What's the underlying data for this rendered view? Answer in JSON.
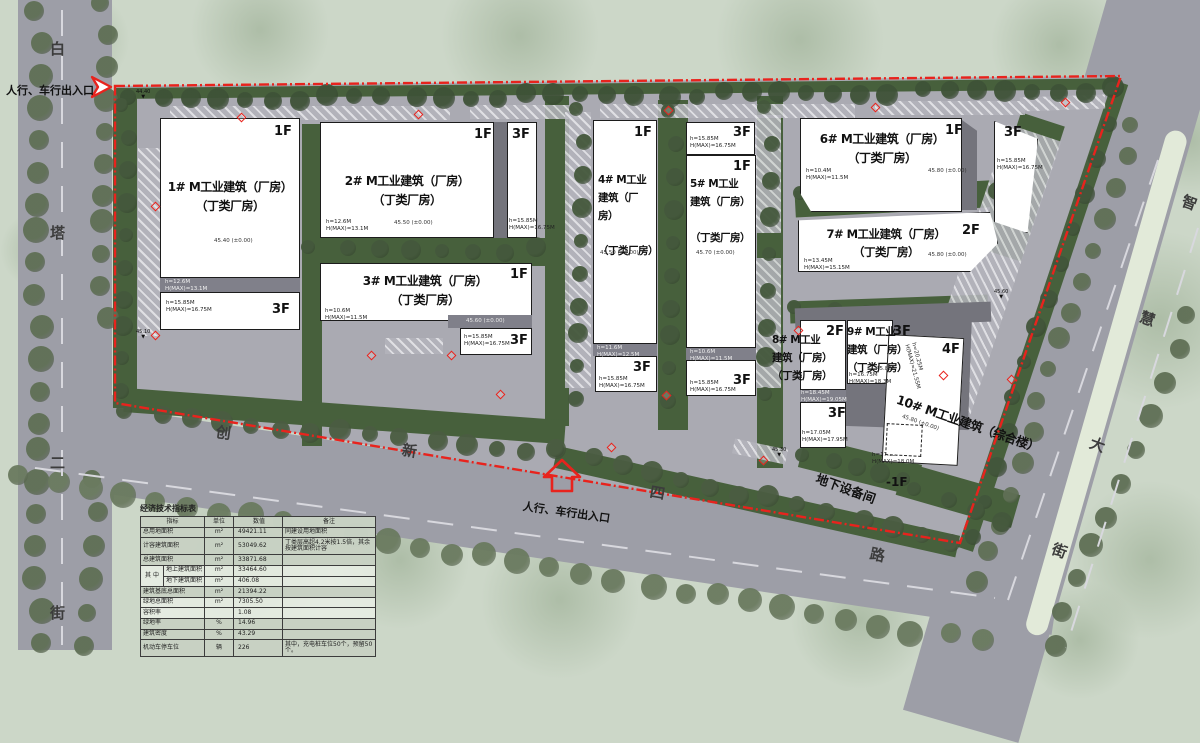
{
  "streets": {
    "west": [
      "白",
      "塔",
      "二",
      "街"
    ],
    "south": [
      "创",
      "新",
      "四",
      "路"
    ],
    "east": [
      "智",
      "慧",
      "大",
      "街"
    ]
  },
  "annotations": {
    "west_entrance": "人行、车行出入口",
    "south_entrance": "人行、车行出入口",
    "underground": "地下设备间"
  },
  "spots": [
    "44.40",
    "45.10",
    "45.30",
    "45.60"
  ],
  "buildings": [
    {
      "title": "1# M工业建筑（厂房）",
      "subtitle": "（丁类厂房）",
      "floor": "1F",
      "elev": "45.40 (±0.00)",
      "h": "h=12.6M\nH(MAX)=13.1M",
      "annex_floor": "3F",
      "annex_h": "h=15.85M\nH(MAX)=16.75M"
    },
    {
      "title": "2# M工业建筑（厂房）",
      "subtitle": "（丁类厂房）",
      "floor": "1F",
      "elev": "45.50 (±0.00)",
      "h": "h=12.6M\nH(MAX)=13.1M",
      "annex_floor": "3F",
      "annex_h": "h=15.85M\nH(MAX)=16.75M"
    },
    {
      "title": "3# M工业建筑（厂房）",
      "subtitle": "（丁类厂房）",
      "floor": "1F",
      "elev": "45.60 (±0.00)",
      "h": "h=10.6M\nH(MAX)=11.5M",
      "annex_floor": "3F",
      "annex_h": "h=15.85M\nH(MAX)=16.75M"
    },
    {
      "title": "4# M工业",
      "title2": "建筑（厂房）",
      "subtitle": "（丁类厂房）",
      "floor": "1F",
      "elev": "45.50 (±0.00)",
      "h": "h=11.6M\nH(MAX)=12.5M",
      "annex_floor": "3F",
      "annex_h": "h=15.85M\nH(MAX)=16.75M"
    },
    {
      "title": "5# M工业",
      "title2": "建筑（厂房）",
      "subtitle": "（丁类厂房）",
      "floor": "1F",
      "elev": "45.70 (±0.00)",
      "h": "h=10.6M\nH(MAX)=11.5M",
      "annex_floor": "3F",
      "annex_h": "h=15.85M\nH(MAX)=16.75M",
      "top_annex_floor": "3F",
      "top_annex_h": "h=15.85M\nH(MAX)=16.75M"
    },
    {
      "title": "6# M工业建筑（厂房）",
      "subtitle": "（丁类厂房）",
      "floor": "1F",
      "elev": "45.80 (±0.00)",
      "h": "h=10.4M\nH(MAX)=11.5M",
      "annex_floor": "3F",
      "annex_h": "h=15.85M\nH(MAX)=16.75M"
    },
    {
      "title": "7# M工业建筑（厂房）",
      "subtitle": "（丁类厂房）",
      "floor": "2F",
      "elev": "45.80 (±0.00)",
      "h": "h=13.45M\nH(MAX)=15.15M"
    },
    {
      "title": "8# M工业",
      "title2": "建筑（厂房）",
      "subtitle": "（丁类厂房）",
      "floor": "2F",
      "floor2": "3F",
      "h": "h=18.45M\nH(MAX)=19.05M",
      "h2": "h=17.05M\nH(MAX)=17.95M"
    },
    {
      "title": "9# M工业",
      "title2": "建筑（厂房）",
      "subtitle": "（丁类厂房）",
      "floor": "3F",
      "elev": "45.80",
      "h": "h=16.75M\nH(MAX)=18.3M"
    },
    {
      "title": "10# M工业建筑（综合楼）",
      "floor": "4F",
      "elev": "45.80 (±0.00)",
      "h": "h=20.25M\nH(MAX)=21.55M",
      "h2": "h=17.05M\nH(MAX)=18.0M",
      "basement": "-1F"
    }
  ],
  "table": {
    "title": "经济技术指标表",
    "headers": [
      "指标",
      "单位",
      "数值",
      "备注"
    ],
    "group_label": "其 中",
    "rows": [
      {
        "label": "总用地面积",
        "unit": "m²",
        "value": "49421.11",
        "remark": "同建设用地面积"
      },
      {
        "label": "计容建筑面积",
        "unit": "m²",
        "value": "53049.62",
        "remark": "丁类层高超4.2米按1.5倍，其余按建筑面积计容"
      },
      {
        "label": "总建筑面积",
        "unit": "m²",
        "value": "33871.68",
        "remark": ""
      },
      {
        "label": "地上建筑面积",
        "unit": "m²",
        "value": "33464.60",
        "remark": ""
      },
      {
        "label": "地下建筑面积",
        "unit": "m²",
        "value": "406.08",
        "remark": ""
      },
      {
        "label": "建筑基底总面积",
        "unit": "m²",
        "value": "21394.22",
        "remark": ""
      },
      {
        "label": "绿地总面积",
        "unit": "m²",
        "value": "7305.50",
        "remark": ""
      },
      {
        "label": "容积率",
        "unit": "",
        "value": "1.08",
        "remark": ""
      },
      {
        "label": "绿地率",
        "unit": "%",
        "value": "14.96",
        "remark": ""
      },
      {
        "label": "建筑密度",
        "unit": "%",
        "value": "43.29",
        "remark": ""
      },
      {
        "label": "机动车停车位",
        "unit": "辆",
        "value": "226",
        "remark": "其中，充电桩车位50个，预留50个。"
      }
    ]
  },
  "colors": {
    "boundary_red": "#e8231d",
    "road_gray": "#9d9ea7",
    "site_gray": "#aaaab2",
    "landscape_green": "#47603c",
    "building_white": "#ffffff"
  }
}
